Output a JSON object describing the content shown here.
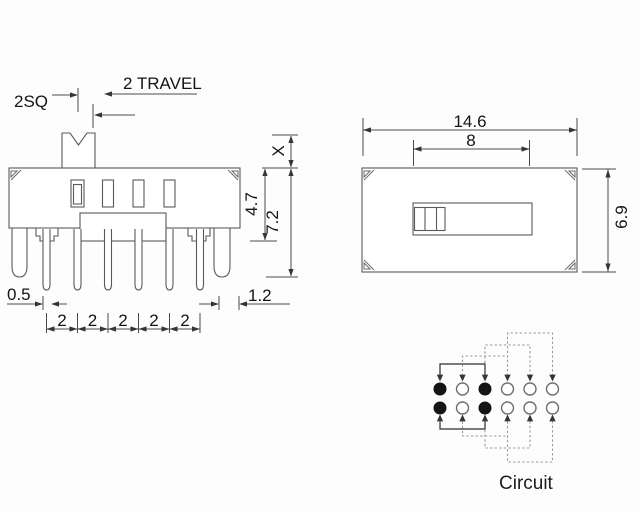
{
  "front_view": {
    "labels": {
      "knob_square": "2SQ",
      "travel": "2 TRAVEL",
      "knob_height": "X",
      "body_height": "4.7",
      "total_height": "7.2",
      "pin_width": "0.5",
      "edge_offset": "1.2"
    },
    "pin_pitch": [
      "2",
      "2",
      "2",
      "2",
      "2"
    ]
  },
  "top_view": {
    "labels": {
      "width": "14.6",
      "slot_travel": "8",
      "depth": "6.9"
    }
  },
  "circuit": {
    "label": "Circuit",
    "terminals": [
      [
        "filled",
        "open",
        "filled",
        "open",
        "open",
        "open"
      ],
      [
        "filled",
        "open",
        "filled",
        "open",
        "open",
        "open"
      ]
    ]
  },
  "colors": {
    "line": "#5a5a5a",
    "dashed": "#9a9a9a",
    "solid": "#2e2e2e",
    "text": "#141414",
    "terminal_filled": "#151515",
    "background": "#fdfdfd"
  }
}
